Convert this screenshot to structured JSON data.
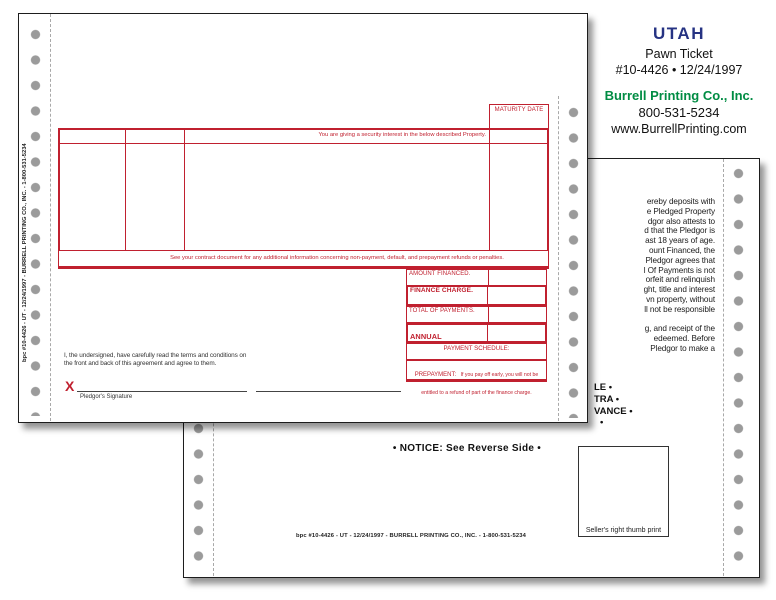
{
  "colors": {
    "form_red": "#c0202f",
    "brand_green": "#008c43",
    "brand_navy": "#263383",
    "hole_gray": "#9b9b9b"
  },
  "info": {
    "state": "UTAH",
    "product": "Pawn Ticket",
    "item_number": "#10-4426 • 12/24/1997",
    "company": "Burrell Printing Co., Inc.",
    "phone": "800-531-5234",
    "website": "www.BurrellPrinting.com"
  },
  "imprint": "bpc #10-4426 - UT - 12/24/1997 - BURRELL PRINTING CO., INC. - 1-800-531-5234",
  "front": {
    "maturity_date_label": "MATURITY DATE",
    "security_interest": "You are giving a security interest in the below described Property.",
    "contract_note": "See your contract document for any additional information concerning non-payment, default, and prepayment refunds or penalties.",
    "rows": [
      {
        "label": "AMOUNT FINANCED.",
        "desc": "The amount of cash given directly to you."
      },
      {
        "label": "FINANCE CHARGE.",
        "desc": "The dollar amount the credit will cost you."
      },
      {
        "label": "TOTAL OF PAYMENTS.",
        "desc": "Amount required to redeem pawn on Maturity Date."
      },
      {
        "label": "ANNUAL PERCENTAGE RATE.",
        "desc": "The cost of your credit as a yearly rate."
      }
    ],
    "payment_schedule_label": "PAYMENT SCHEDULE:",
    "payment_schedule_desc": "Total of Payments is due on Maturity Date shown above",
    "prepayment_label": "PREPAYMENT:",
    "prepayment_desc": "If you pay off early, you will not be entitled to a refund of part of the finance charge.",
    "agreement": "I, the undersigned, have carefully read the terms and conditions on the front and back of this agreement and agree to them.",
    "signature_x": "X",
    "signature_label": "Pledgor's Signature"
  },
  "back": {
    "paragraph_lines": [
      "ereby deposits with",
      "e Pledged Property",
      "dgor also attests to",
      "d that the Pledgor is",
      "ast 18 years of age.",
      "ount Financed, the",
      "Pledgor agrees that",
      "l Of Payments is not",
      "orfeit and relinquish",
      "ght, title and interest",
      "vn property, without",
      "ll not be responsible",
      "",
      "g, and receipt of the",
      "edeemed.  Before",
      "Pledgor to make a"
    ],
    "bullets": [
      "LE •",
      "TRA •",
      "VANCE •",
      "•"
    ],
    "notice": "• NOTICE: See Reverse Side •",
    "thumb_print_label": "Seller's right thumb print"
  }
}
